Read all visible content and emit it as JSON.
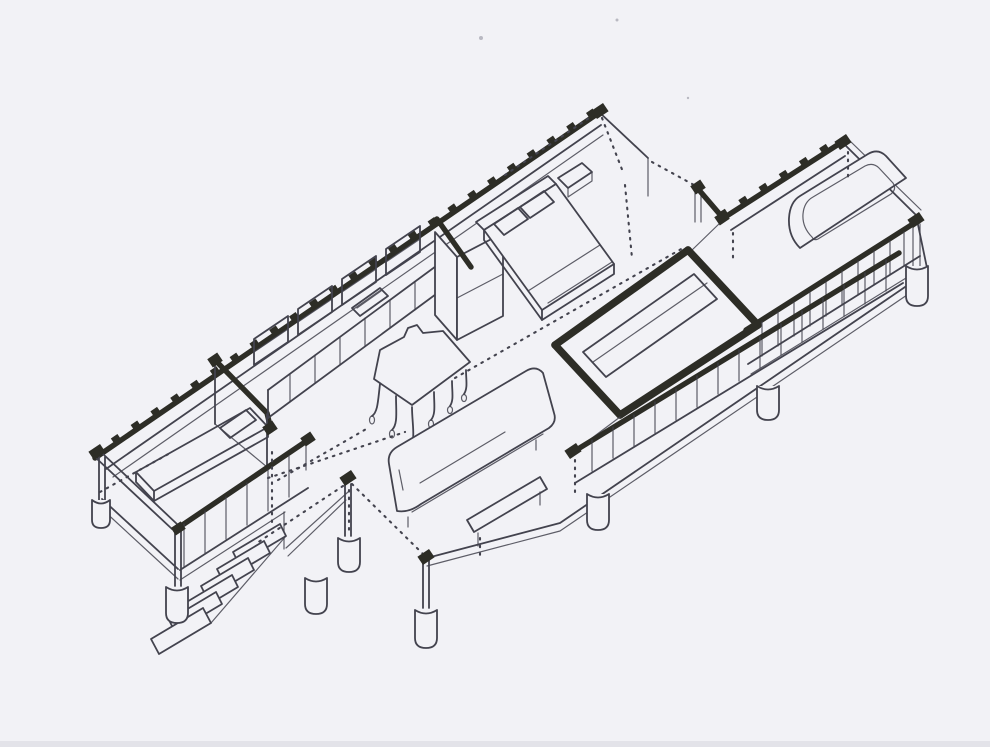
{
  "document": {
    "kind": "scanned hand-drawn isometric architecture sketch",
    "description": "Hand-drawn isometric cutaway sketch of an elongated single-storey house raised on round pier footings, with corrugated cut walls, two bedrooms, a kitchen with counter and dining table, a living area with sofa and low table, an inner thick-walled room, a bathroom with tub, louvered window bands, deck railings and an exterior stair"
  },
  "palette": {
    "paper": "#f2f2f6",
    "ink": "#43434e",
    "heavy": "#2d2d26",
    "shade": "#d7d7de"
  },
  "parts": {
    "sketch": "isometric cutaway house sketch",
    "back_wall": "corrugated long back wall (cut)",
    "right_back_wall": "corrugated bathroom back wall (cut)",
    "left_end": "left end wall, corner post and footing",
    "left_bedroom": "left bedroom with single bed",
    "partition": "cut partition wall between bedroom and kitchen",
    "kitchen": "kitchen counter, wall cabinets and tall cabinet",
    "dining_set": "dining table with chairs",
    "master_bedroom": "master bedroom with double bed and nightstand",
    "inner_room": "inner room with thick cut walls and bed",
    "bathroom": "bathroom with bathtub and end wall",
    "louver_band": "louvered window band at bathroom front",
    "deck_railing": "left deck railing with balusters",
    "front_railing": "long front deck railing with balusters",
    "stairs": "exterior entry stair",
    "living_room": "living room sofa and low table",
    "posts": "slender support posts",
    "footings": "round concrete pier footings",
    "section_lines": "dotted section cut lines",
    "wall_caps": "blackened cut wall caps",
    "scan_artifacts": "scanner specks and edge shade"
  }
}
